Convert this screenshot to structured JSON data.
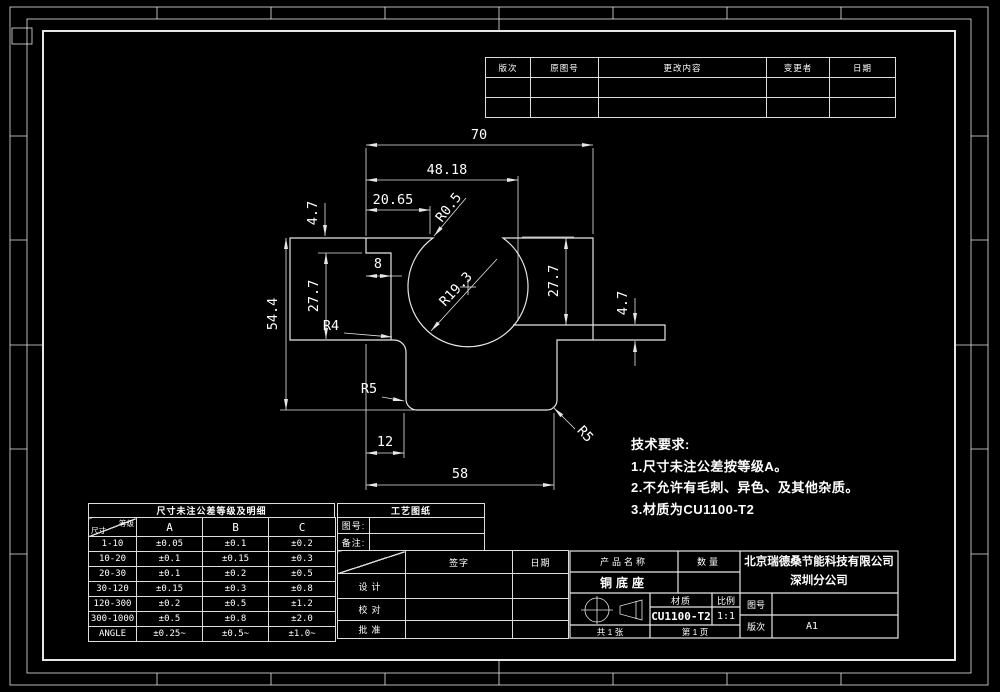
{
  "revision_table": {
    "headers": [
      "版次",
      "原图号",
      "更改内容",
      "变更者",
      "日期"
    ],
    "empty_rows": 2
  },
  "tech_requirements": {
    "title": "技术要求:",
    "items": [
      "1.尺寸未注公差按等级A。",
      "2.不允许有毛刺、异色、及其他杂质。",
      "3.材质为CU1100-T2"
    ]
  },
  "tolerance_table": {
    "title": "尺寸未注公差等级及明细",
    "corner_top": "等级",
    "corner_bottom": "尺寸",
    "columns": [
      "A",
      "B",
      "C"
    ],
    "rows": [
      [
        "1-10",
        "±0.05",
        "±0.1",
        "±0.2"
      ],
      [
        "10-20",
        "±0.1",
        "±0.15",
        "±0.3"
      ],
      [
        "20-30",
        "±0.1",
        "±0.2",
        "±0.5"
      ],
      [
        "30-120",
        "±0.15",
        "±0.3",
        "±0.8"
      ],
      [
        "120-300",
        "±0.2",
        "±0.5",
        "±1.2"
      ],
      [
        "300-1000",
        "±0.5",
        "±0.8",
        "±2.0"
      ],
      [
        "ANGLE",
        "±0.25~",
        "±0.5~",
        "±1.0~"
      ]
    ]
  },
  "process_block": {
    "title": "工艺图纸",
    "fields": [
      {
        "label": "图号:"
      },
      {
        "label": "备注:"
      }
    ],
    "sign_header": "签字",
    "date_header": "日期",
    "rows": [
      "设计",
      "校对",
      "批准"
    ]
  },
  "title_block": {
    "product_label": "产品名称",
    "qty_label": "数量",
    "product_name": "铜底座",
    "company_line1": "北京瑞德桑节能科技有限公司",
    "company_line2": "深圳分公司",
    "material_label": "材质",
    "material": "CU1100-T2",
    "scale_label": "比例",
    "scale": "1:1",
    "drawing_no_label": "图号",
    "revision_label": "版次",
    "revision": "A1",
    "sheet_count": "共 1 张",
    "page": "第 1 页"
  },
  "dimensions": [
    {
      "t": "70",
      "x": 479,
      "y": 139
    },
    {
      "t": "48.18",
      "x": 447,
      "y": 174
    },
    {
      "t": "20.65",
      "x": 393,
      "y": 204
    },
    {
      "t": "R0.5",
      "x": 452,
      "y": 210,
      "r": -52
    },
    {
      "t": "4.7",
      "x": 317,
      "y": 213,
      "r": -90
    },
    {
      "t": "8",
      "x": 378,
      "y": 268
    },
    {
      "t": "27.7",
      "x": 318,
      "y": 296,
      "r": -90
    },
    {
      "t": "54.4",
      "x": 277,
      "y": 314,
      "r": -90
    },
    {
      "t": "R4",
      "x": 331,
      "y": 330
    },
    {
      "t": "R19.3",
      "x": 459,
      "y": 292,
      "r": -47
    },
    {
      "t": "27.7",
      "x": 558,
      "y": 281,
      "r": -90
    },
    {
      "t": "4.7",
      "x": 627,
      "y": 303,
      "r": -90
    },
    {
      "t": "R5",
      "x": 369,
      "y": 393
    },
    {
      "t": "R5",
      "x": 582,
      "y": 437,
      "r": 47
    },
    {
      "t": "12",
      "x": 385,
      "y": 446
    },
    {
      "t": "58",
      "x": 460,
      "y": 478
    }
  ]
}
